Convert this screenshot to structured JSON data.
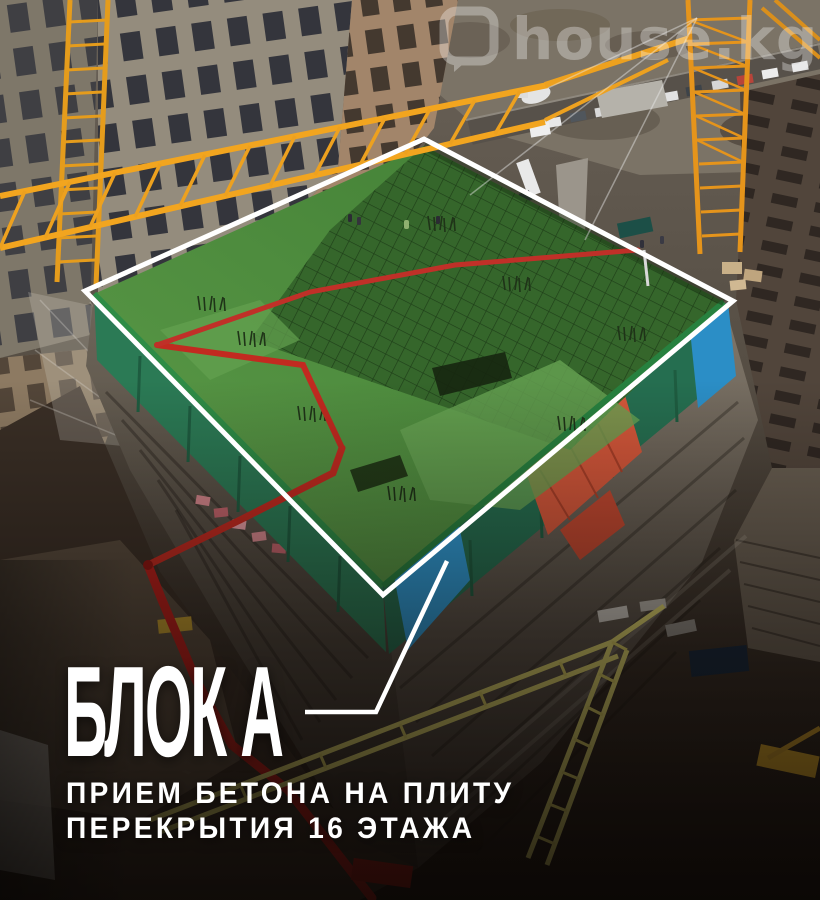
{
  "watermark": {
    "text": "house.kg"
  },
  "caption": {
    "title": "БЛОК А",
    "subtitle_line1": "ПРИЕМ БЕТОНА НА ПЛИТУ",
    "subtitle_line2": "ПЕРЕКРЫТИЯ 16 ЭТАЖА"
  },
  "scene": {
    "description": "Aerial drone photo of a high-rise construction site: the top floor slab of the tower block is tinted green and outlined in white, with a callout line linking it to the caption; tower cranes, a red concrete-pump boom, tarpaulins and neighbouring unfinished buildings surround it.",
    "highlight": {
      "fill": "#4e8f3c",
      "outline": "#ffffff"
    },
    "colors": {
      "crane_yellow": "#eda11f",
      "pale_crane_yellow": "#d9d06c",
      "pump_red": "#c22a20",
      "tarp_blue": "#2f9ad4",
      "tarp_orange": "#d4573a",
      "netting_green": "#2b7a55",
      "ground_dark": "#241c16",
      "text": "#ffffff"
    }
  }
}
